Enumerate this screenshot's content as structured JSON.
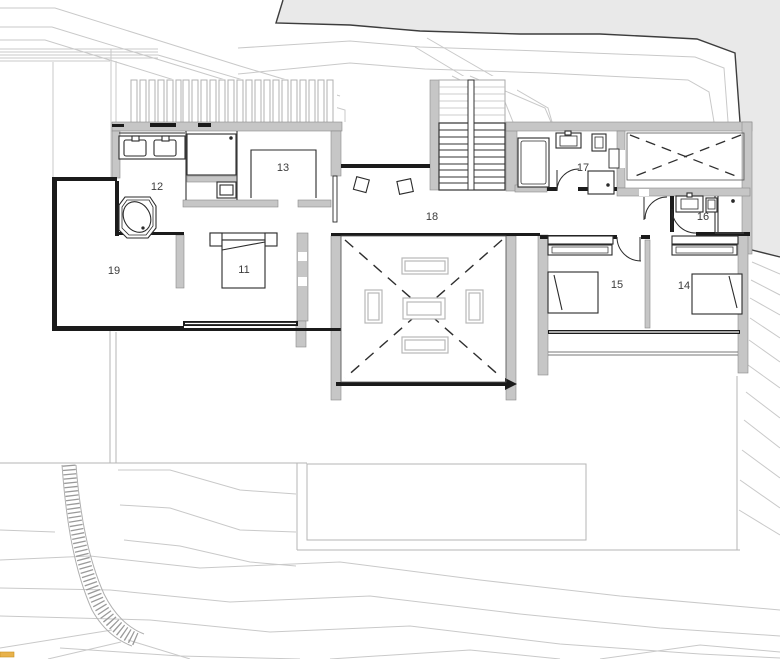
{
  "drawing": {
    "type": "architectural floor plan",
    "description": "upper floor plan with bedrooms, bathrooms, stair, double-height void and terrain contours"
  },
  "room_labels": [
    "11",
    "12",
    "13",
    "14",
    "15",
    "16",
    "17",
    "18",
    "19"
  ],
  "colors": {
    "terrain": "#e9e9e9",
    "wall_gray": "#c6c6c6",
    "wall_dark": "#1b1b1b",
    "contour": "#c9c9c9",
    "terrace_line": "#b5b5b5",
    "furniture": "#b8b8b8",
    "fixture": "#2b2b2b",
    "accent": "#e8b24b",
    "label": "#3c3c3c"
  }
}
